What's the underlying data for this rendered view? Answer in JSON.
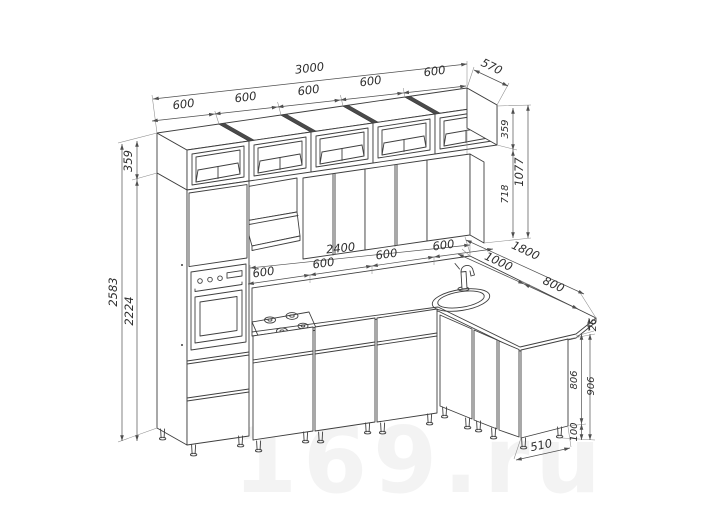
{
  "title": "kitchen-layout-technical-drawing",
  "watermark": "169.ru",
  "colors": {
    "background": "#ffffff",
    "drawing_line": "#3f3f3f",
    "dimension_line": "#4f4f4f",
    "extension_line": "#8b8b8b",
    "dimension_text": "#2e2e2e"
  },
  "dims": {
    "top_total": "3000",
    "top_units": [
      "600",
      "600",
      "600",
      "600",
      "600"
    ],
    "top_depth": "570",
    "left_box_height": "359",
    "left_total_height": "2583",
    "left_tall_height": "2224",
    "right_box_height": "359",
    "right_wall_cab_height": "718",
    "right_upper_total": "1077",
    "base_run": "2400",
    "base_units": [
      "600",
      "600",
      "600",
      "600"
    ],
    "return_total": "1800",
    "return_corner": "1000",
    "return_cabinet": "800",
    "counter_thickness": "26",
    "right_cabinet_height": "806",
    "right_total_height": "906",
    "legs_height": "100",
    "right_cabinet_depth": "510"
  }
}
